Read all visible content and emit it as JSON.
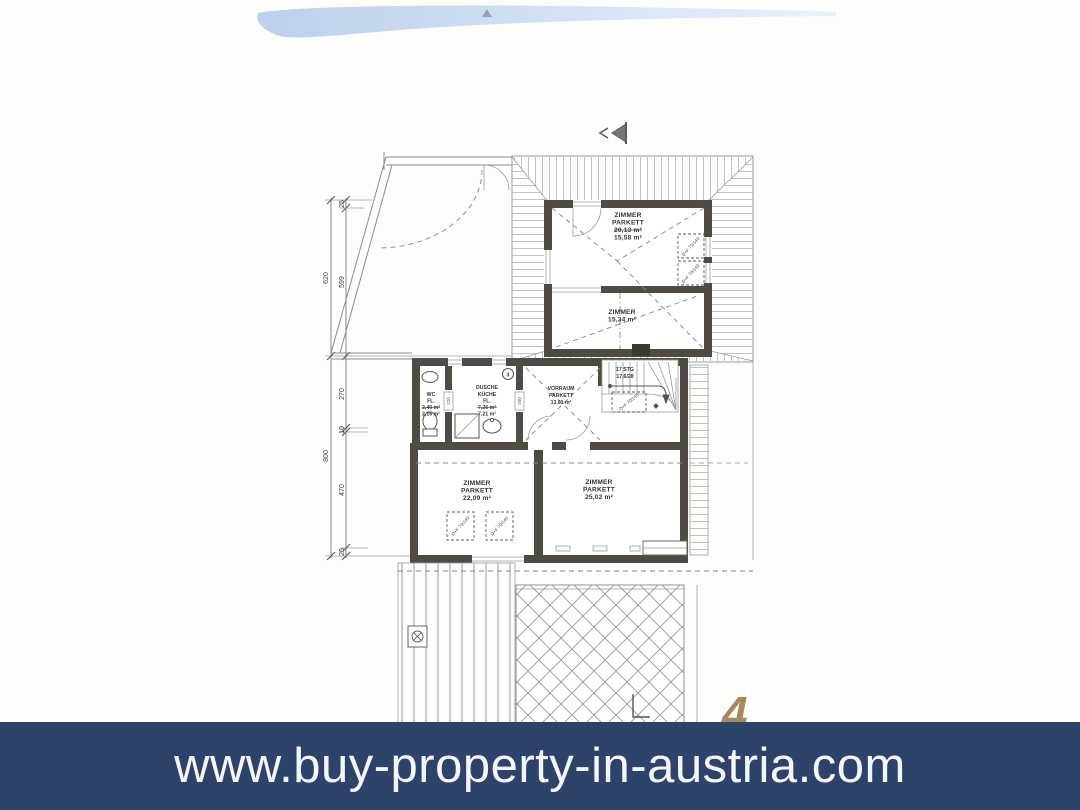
{
  "banner": {
    "url": "www.buy-property-in-austria.com"
  },
  "page_number": "4",
  "colors": {
    "banner_bg": "#2d436a",
    "banner_text": "#f4f6f9",
    "page_number": "#a8875d",
    "swoosh": "#c3d3ed",
    "wall": "#4f4b43",
    "line": "#8a8d89"
  },
  "plan": {
    "dims": {
      "d25a": "25",
      "d599": "599",
      "d620": "620",
      "d270": "270",
      "d10": "10",
      "d470": "470",
      "d25b": "25",
      "d800": "800"
    },
    "rooms": {
      "zimmer_nord": {
        "l1": "ZIMMER",
        "l2": "PARKETT",
        "old": "20,13 m²",
        "new": "15,58 m²"
      },
      "zimmer_mitte": {
        "l1": "ZIMMER",
        "new": "15,34 m²"
      },
      "wc": {
        "l1": "WC",
        "l2": "FL.",
        "old": "2,40 m²",
        "new": "2,16 m²"
      },
      "kueche": {
        "l1": "DUSCHE",
        "l2": "KÜCHE",
        "l3": "FL.",
        "old": "7,26 m²",
        "new": "7,21 m²"
      },
      "vorraum": {
        "l1": "VORRAUM",
        "l2": "PARKETT",
        "new": "13,61 m²"
      },
      "zimmer_sw": {
        "l1": "ZIMMER",
        "l2": "PARKETT",
        "new": "22,09 m²"
      },
      "zimmer_so": {
        "l1": "ZIMMER",
        "l2": "PARKETT",
        "new": "25,02 m²"
      }
    },
    "stairs": {
      "l1": "17 STG",
      "l2": "17,6/28"
    },
    "roof_window": "D+F 70/140",
    "kitchen_badge": "3",
    "door_labels": {
      "d1": "220",
      "d2": "200"
    }
  }
}
